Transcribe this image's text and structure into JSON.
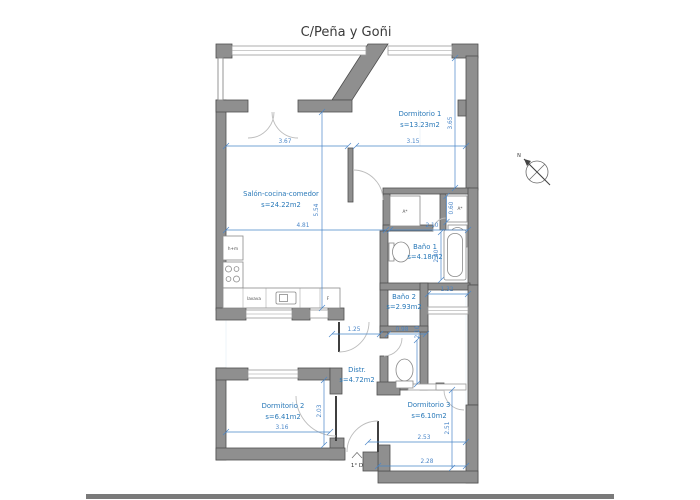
{
  "title": "C/Peña y Goñi",
  "compass": {
    "north": "N"
  },
  "entrance": {
    "label": "1° D"
  },
  "rooms": [
    {
      "name": "Dormitorio 1",
      "area": "s=13.23m2"
    },
    {
      "name": "Salón-cocina-comedor",
      "area": "s=24.22m2"
    },
    {
      "name": "Baño 1",
      "area": "s=4.18m2"
    },
    {
      "name": "Baño 2",
      "area": "s=2.93m2"
    },
    {
      "name": "Distr.",
      "area": "s=4.72m2"
    },
    {
      "name": "Dormitorio 2",
      "area": "s=6.41m2"
    },
    {
      "name": "Dormitorio 3",
      "area": "s=6.10m2"
    }
  ],
  "fixtures": {
    "oven_micro": "h+m",
    "dishwasher": "lavava",
    "fridge": "F",
    "washer": "T",
    "washer_label": "lavad",
    "closet_1": "A*",
    "closet_2": "A*"
  },
  "dimensions": {
    "salon_width": "3.67",
    "dorm1_width": "3.15",
    "dorm1_height": "3.65",
    "salon_height": "5.54",
    "salon_bottom": "4.81",
    "bano1_width": "2.10",
    "closet_depth": "0.60",
    "bano1_height": "2.40",
    "galeria_width": "1.32",
    "distr_width": "1.25",
    "wc_width": "0.98",
    "wc_height": "2.10",
    "dorm2_height": "2.03",
    "dorm2_width": "3.16",
    "dorm3_width": "2.53",
    "dorm3_height": "2.51",
    "dorm3_bottom": "2.28"
  },
  "colors": {
    "wall": "#8f8f8f",
    "wall_stroke": "#4f4f4f",
    "dimension": "#4a86c8",
    "room_label": "#2878b8",
    "title": "#3a3a3a"
  }
}
